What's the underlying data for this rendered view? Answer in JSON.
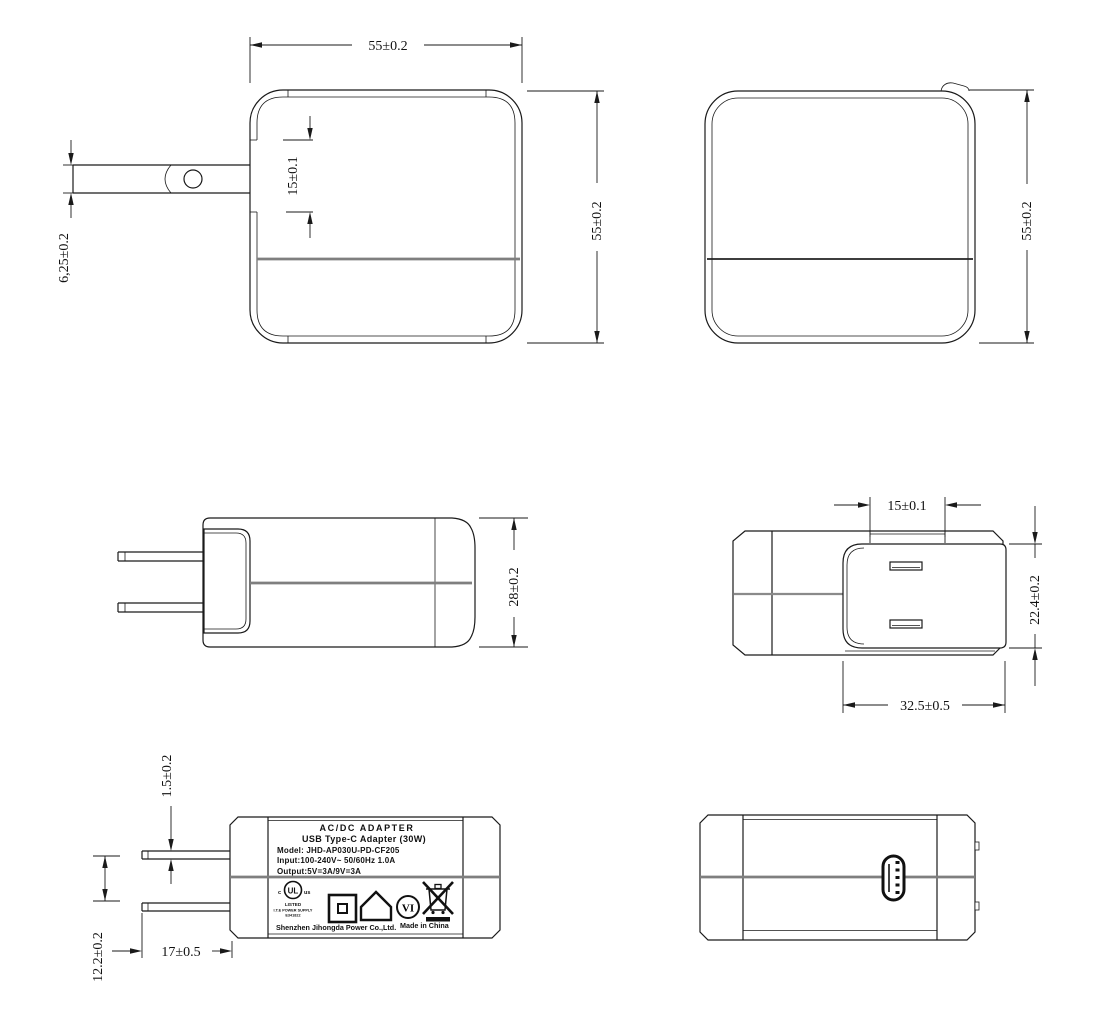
{
  "meta": {
    "background": "#ffffff",
    "line_color": "#1a1a1a",
    "parting_line_gray": "#7f7f7f"
  },
  "dimensions": {
    "front_width": "55±0.2",
    "front_height": "55±0.2",
    "front_plug_recess": "15±0.1",
    "front_blade_width": "6,25±0.2",
    "rear_height": "55±0.2",
    "side_thickness": "28±0.2",
    "top_blade_span": "15±0.1",
    "top_plug_base_height": "22.4±0.2",
    "top_plug_base_width": "32.5±0.5",
    "label_blade_thickness": "1.5±0.2",
    "label_blade_spacing": "12.2±0.2",
    "label_blade_length": "17±0.5"
  },
  "label": {
    "title": "AC/DC  ADAPTER",
    "subtitle": "USB Type-C Adapter   (30W)",
    "model": "Model: JHD-AP030U-PD-CF205",
    "input": "Input:100-240V~  50/60Hz  1.0A",
    "output": "Output:5V=3A/9V=3A",
    "ul": {
      "c": "c",
      "mark": "UL",
      "us": "us",
      "listed": "LISTED",
      "type": "I.T.E POWER SUPPLY",
      "file": "E341822"
    },
    "efficiency": "VI",
    "manufacturer": "Shenzhen Jihongda Power Co.,Ltd.",
    "origin": "Made in China"
  }
}
